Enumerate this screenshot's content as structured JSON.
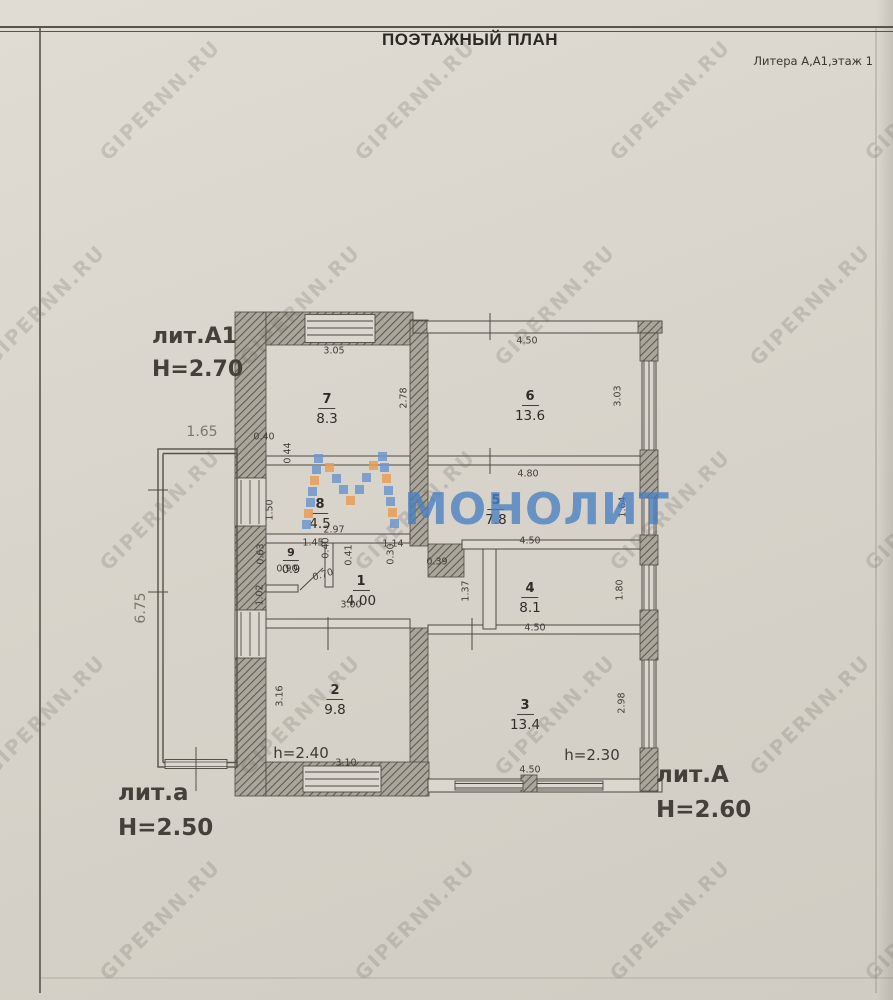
{
  "page": {
    "title": "ПОЭТАЖНЫЙ ПЛАН",
    "litera": "Литера А,А1,этаж 1"
  },
  "watermark": {
    "tile": "GIPERNN.RU",
    "logo": "МОНОЛИТ",
    "logo_color": "#4a80c2",
    "mosaic_blue": "#6e98cd",
    "mosaic_orange": "#e79f58"
  },
  "blocks": {
    "a1": {
      "label": "лит.А1",
      "height": "Н=2.70"
    },
    "a_small": {
      "label": "лит.а",
      "height": "Н=2.50"
    },
    "a": {
      "label": "лит.А",
      "height": "Н=2.60"
    }
  },
  "rooms": [
    {
      "number": "7",
      "area": "8.3"
    },
    {
      "number": "6",
      "area": "13.6"
    },
    {
      "number": "8",
      "area": "4.5"
    },
    {
      "number": "5",
      "area": "7.8"
    },
    {
      "number": "9",
      "area": "0.9"
    },
    {
      "number": "1",
      "area": "4.00"
    },
    {
      "number": "4",
      "area": "8.1"
    },
    {
      "number": "2",
      "area": "9.8"
    },
    {
      "number": "3",
      "area": "13.4"
    }
  ],
  "dims": {
    "r7_top": "3.05",
    "r7_right": "2.78",
    "r6_top": "4.50",
    "r6_right": "3.03",
    "annex_top": "1.65",
    "annex_left": "6.75",
    "win_w": "0.40",
    "win_h": "0.44",
    "r8_left": "1.50",
    "r8_bottom": "2.97",
    "r5_top": "4.80",
    "r5_bottom": "4.50",
    "r5_right": "1.64",
    "r9_left": "0.63",
    "r9_top": "1.45",
    "r9_w1": "0.40",
    "r9_bottom": "0.90",
    "r9_door": "0.70",
    "r9_w2": "0.41",
    "r1_top": "1.14",
    "r1_w": "0.30",
    "r1_niche": "0.39",
    "r1_bottom": "3.00",
    "r1_right": "1.37",
    "r1_left": "1.02",
    "r4_bottom": "4.50",
    "r4_right": "1.80",
    "r2_left": "3.16",
    "r2_bottom": "3.10",
    "r2_h": "h=2.40",
    "r3_bottom": "4.50",
    "r3_right": "2.98",
    "r3_h": "h=2.30"
  }
}
